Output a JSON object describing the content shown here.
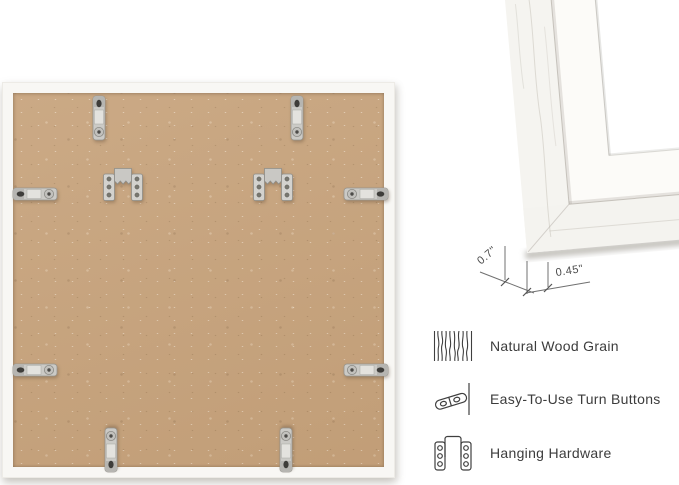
{
  "corner_detail": {
    "depth_label": "0.7\"",
    "face_width_label": "0.45\""
  },
  "features": [
    {
      "icon": "wood-grain-icon",
      "label": "Natural Wood Grain"
    },
    {
      "icon": "turn-button-icon",
      "label": "Easy-To-Use Turn Buttons"
    },
    {
      "icon": "hanging-hardware-icon",
      "label": "Hanging Hardware"
    }
  ],
  "colors": {
    "background": "#ffffff",
    "mdf_board": "#c7a37c",
    "frame_white": "#f5f4f0",
    "hardware_silver": "#cbcac6",
    "text": "#3c3c3c",
    "dimension_lines": "#707070"
  }
}
